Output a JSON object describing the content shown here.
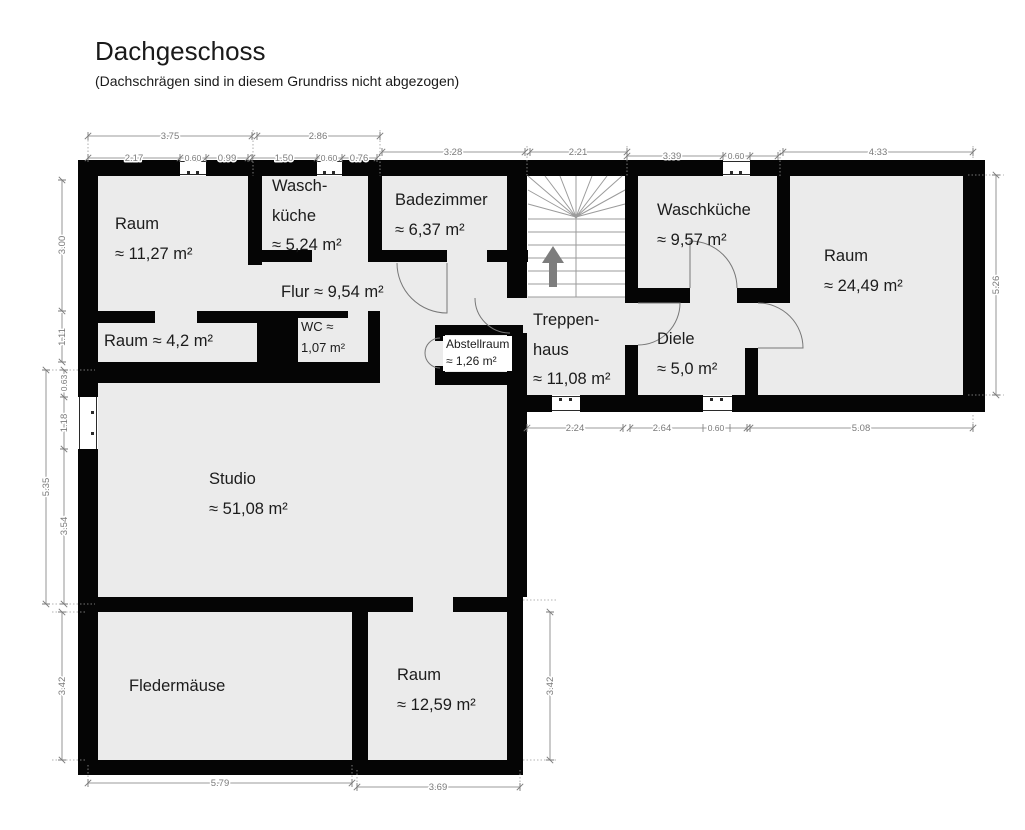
{
  "title": "Dachgeschoss",
  "subtitle": "(Dachschrägen sind in diesem Grundriss nicht abgezogen)",
  "rooms": {
    "raum_nw": {
      "lines": [
        "Raum",
        "≈ 11,27 m²"
      ]
    },
    "waschkueche_klein": {
      "lines": [
        "Wasch-",
        "küche",
        "≈ 5,24 m²"
      ]
    },
    "badezimmer": {
      "lines": [
        "Badezimmer",
        "≈ 6,37 m²"
      ]
    },
    "flur": {
      "lines": [
        "Flur ≈ 9,54 m²"
      ]
    },
    "raum_mitte": {
      "lines": [
        "Raum ≈ 4,2 m²"
      ]
    },
    "wc": {
      "lines": [
        "WC ≈",
        "1,07 m²"
      ]
    },
    "abstellraum": {
      "lines": [
        "Abstellraum",
        "≈ 1,26 m²"
      ]
    },
    "treppenhaus": {
      "lines": [
        "Treppen-",
        "haus",
        "≈ 11,08 m²"
      ]
    },
    "diele": {
      "lines": [
        "Diele",
        "≈ 5,0 m²"
      ]
    },
    "waschkueche_gross": {
      "lines": [
        "Waschküche",
        "≈ 9,57 m²"
      ]
    },
    "raum_no": {
      "lines": [
        "Raum",
        "≈ 24,49 m²"
      ]
    },
    "studio": {
      "lines": [
        "Studio",
        "≈ 51,08 m²"
      ]
    },
    "fledermaeuse": {
      "lines": [
        "Fledermäuse"
      ]
    },
    "raum_sw": {
      "lines": [
        "Raum",
        "≈ 12,59 m²"
      ]
    }
  },
  "dimensions": {
    "top_outer": [
      "3.75",
      "2.86"
    ],
    "top_inner": [
      "2.17",
      "0.60",
      "0.99",
      "1.50",
      "0.60",
      "0.76"
    ],
    "top_mid": [
      "3.28",
      "2.21"
    ],
    "top_right": [
      "3.39",
      "0.60",
      "4.33"
    ],
    "left": [
      "3.00",
      "1.11",
      "0.63",
      "1.18",
      "3.54",
      "5.35",
      "3.42"
    ],
    "right": [
      "5.26"
    ],
    "wing_bottom": [
      "2.24",
      "2.64",
      "0.60",
      "5.08"
    ],
    "bottom": [
      "5.79",
      "3.69"
    ],
    "right_inner": [
      "3.42"
    ]
  }
}
